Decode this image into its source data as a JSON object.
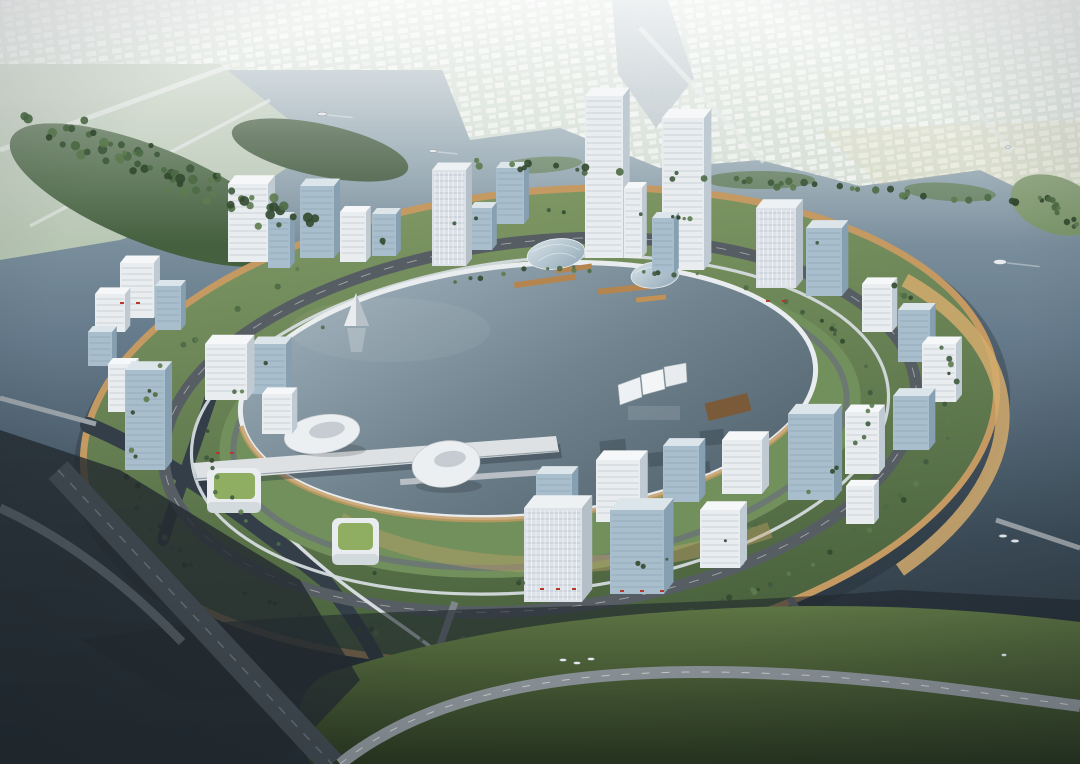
{
  "scene": {
    "title": "Aerial architectural rendering of a circular lakefront business district",
    "setting": "Ring-shaped island development around a circular central lagoon, surrounded by river water, distant low-rise city on the far shore, green parkland in the foreground",
    "time_of_day": "overcast daylight",
    "style": "photorealistic masterplan visualization"
  },
  "palette": {
    "water_far": "#aebcc2",
    "water_mid": "#64798a",
    "water_near": "#232b32",
    "lake_top": "#a3b4bf",
    "lake_mid": "#71848f",
    "lake_bottom": "#4e5f6a",
    "island_green": "#7d9663",
    "island_green_dark": "#47603c",
    "inner_green": "#71905c",
    "tree_green": "#3f5a3e",
    "shore_orange": "#c49a62",
    "beach_tan": "#d4ab6d",
    "ring_road": "#565e64",
    "road_dark": "#3e464d",
    "monorail": "#d5dbdf",
    "building_white": "#e9edf0",
    "building_glass": "#a9becd",
    "building_shade": "#87a0b1",
    "pier_white": "#dde1e4",
    "wood_dock": "#b5854f",
    "deck_brown": "#7a5a38",
    "roof_green": "#8fae62",
    "mainland": "#cfd9cf",
    "city_block": "#f0f3f0",
    "forest": "#44603e",
    "shore_green": "#5d7444",
    "haze": "#f2f6f4",
    "accent_red": "#b5392f",
    "boat_white": "#e8ecef"
  },
  "features": {
    "landmarks": [
      "circular ring island",
      "central circular lagoon",
      "twin office towers",
      "elevated monorail loop",
      "ring boulevard",
      "lakeside pier",
      "floating sail screens",
      "white pyramid lake sculpture",
      "egg-shaped pavilions",
      "green-roof cube pavilions",
      "gridshell glass domes",
      "timber docks",
      "orange waterfront promenade",
      "distant low-rise city",
      "river channels and canals",
      "foreground parkland with boulevard",
      "small boats"
    ],
    "red_awnings": [
      [
        540,
        588
      ],
      [
        556,
        588
      ],
      [
        572,
        588
      ],
      [
        620,
        590
      ],
      [
        640,
        590
      ],
      [
        660,
        590
      ],
      [
        766,
        300
      ],
      [
        782,
        300
      ],
      [
        216,
        452
      ],
      [
        230,
        452
      ],
      [
        120,
        302
      ],
      [
        136,
        302
      ]
    ]
  },
  "buildings": [
    {
      "x": 95,
      "y": 332,
      "w": 30,
      "h": 38,
      "t": "w"
    },
    {
      "x": 120,
      "y": 318,
      "w": 34,
      "h": 55,
      "t": "w"
    },
    {
      "x": 155,
      "y": 330,
      "w": 26,
      "h": 44,
      "t": "g"
    },
    {
      "x": 228,
      "y": 262,
      "w": 40,
      "h": 78,
      "t": "w"
    },
    {
      "x": 268,
      "y": 268,
      "w": 22,
      "h": 50,
      "t": "g"
    },
    {
      "x": 300,
      "y": 258,
      "w": 34,
      "h": 72,
      "t": "g"
    },
    {
      "x": 340,
      "y": 262,
      "w": 26,
      "h": 50,
      "t": "w"
    },
    {
      "x": 372,
      "y": 256,
      "w": 24,
      "h": 42,
      "t": "g"
    },
    {
      "x": 432,
      "y": 266,
      "w": 34,
      "h": 96,
      "t": "s"
    },
    {
      "x": 470,
      "y": 250,
      "w": 22,
      "h": 42,
      "t": "g"
    },
    {
      "x": 496,
      "y": 224,
      "w": 28,
      "h": 56,
      "t": "g"
    },
    {
      "x": 585,
      "y": 258,
      "w": 38,
      "h": 162,
      "t": "w"
    },
    {
      "x": 624,
      "y": 258,
      "w": 18,
      "h": 70,
      "t": "w"
    },
    {
      "x": 662,
      "y": 270,
      "w": 42,
      "h": 152,
      "t": "w"
    },
    {
      "x": 652,
      "y": 274,
      "w": 22,
      "h": 56,
      "t": "g"
    },
    {
      "x": 756,
      "y": 288,
      "w": 40,
      "h": 80,
      "t": "s"
    },
    {
      "x": 806,
      "y": 296,
      "w": 36,
      "h": 68,
      "t": "g"
    },
    {
      "x": 862,
      "y": 332,
      "w": 30,
      "h": 48,
      "t": "w"
    },
    {
      "x": 898,
      "y": 362,
      "w": 32,
      "h": 52,
      "t": "g"
    },
    {
      "x": 922,
      "y": 402,
      "w": 34,
      "h": 58,
      "t": "w"
    },
    {
      "x": 893,
      "y": 450,
      "w": 36,
      "h": 54,
      "t": "g"
    },
    {
      "x": 845,
      "y": 474,
      "w": 34,
      "h": 62,
      "t": "w"
    },
    {
      "x": 788,
      "y": 500,
      "w": 46,
      "h": 86,
      "t": "g"
    },
    {
      "x": 846,
      "y": 524,
      "w": 28,
      "h": 38,
      "t": "w"
    },
    {
      "x": 722,
      "y": 494,
      "w": 40,
      "h": 54,
      "t": "w"
    },
    {
      "x": 663,
      "y": 502,
      "w": 36,
      "h": 56,
      "t": "g"
    },
    {
      "x": 596,
      "y": 522,
      "w": 44,
      "h": 62,
      "t": "w"
    },
    {
      "x": 536,
      "y": 530,
      "w": 36,
      "h": 56,
      "t": "g"
    },
    {
      "x": 524,
      "y": 602,
      "w": 58,
      "h": 94,
      "t": "s"
    },
    {
      "x": 610,
      "y": 594,
      "w": 54,
      "h": 84,
      "t": "g"
    },
    {
      "x": 700,
      "y": 568,
      "w": 40,
      "h": 58,
      "t": "w"
    },
    {
      "x": 205,
      "y": 400,
      "w": 42,
      "h": 56,
      "t": "w"
    },
    {
      "x": 252,
      "y": 394,
      "w": 34,
      "h": 50,
      "t": "g"
    },
    {
      "x": 262,
      "y": 434,
      "w": 30,
      "h": 40,
      "t": "w"
    },
    {
      "x": 125,
      "y": 470,
      "w": 40,
      "h": 100,
      "t": "g"
    },
    {
      "x": 108,
      "y": 412,
      "w": 26,
      "h": 48,
      "t": "w"
    },
    {
      "x": 88,
      "y": 366,
      "w": 24,
      "h": 34,
      "t": "g"
    }
  ],
  "boats": [
    {
      "x": 322,
      "y": 114,
      "s": 10,
      "wake": true
    },
    {
      "x": 433,
      "y": 151,
      "s": 8,
      "wake": true
    },
    {
      "x": 1000,
      "y": 262,
      "s": 13,
      "wake": true
    },
    {
      "x": 1008,
      "y": 147,
      "s": 5,
      "wake": true
    },
    {
      "x": 563,
      "y": 660,
      "s": 7,
      "wake": false
    },
    {
      "x": 577,
      "y": 663,
      "s": 7,
      "wake": false
    },
    {
      "x": 591,
      "y": 659,
      "s": 7,
      "wake": false
    },
    {
      "x": 1003,
      "y": 536,
      "s": 8,
      "wake": false
    },
    {
      "x": 1015,
      "y": 541,
      "s": 8,
      "wake": false
    },
    {
      "x": 1004,
      "y": 655,
      "s": 5,
      "wake": false
    }
  ],
  "counts": {
    "buildings": 37,
    "boats": 10
  }
}
